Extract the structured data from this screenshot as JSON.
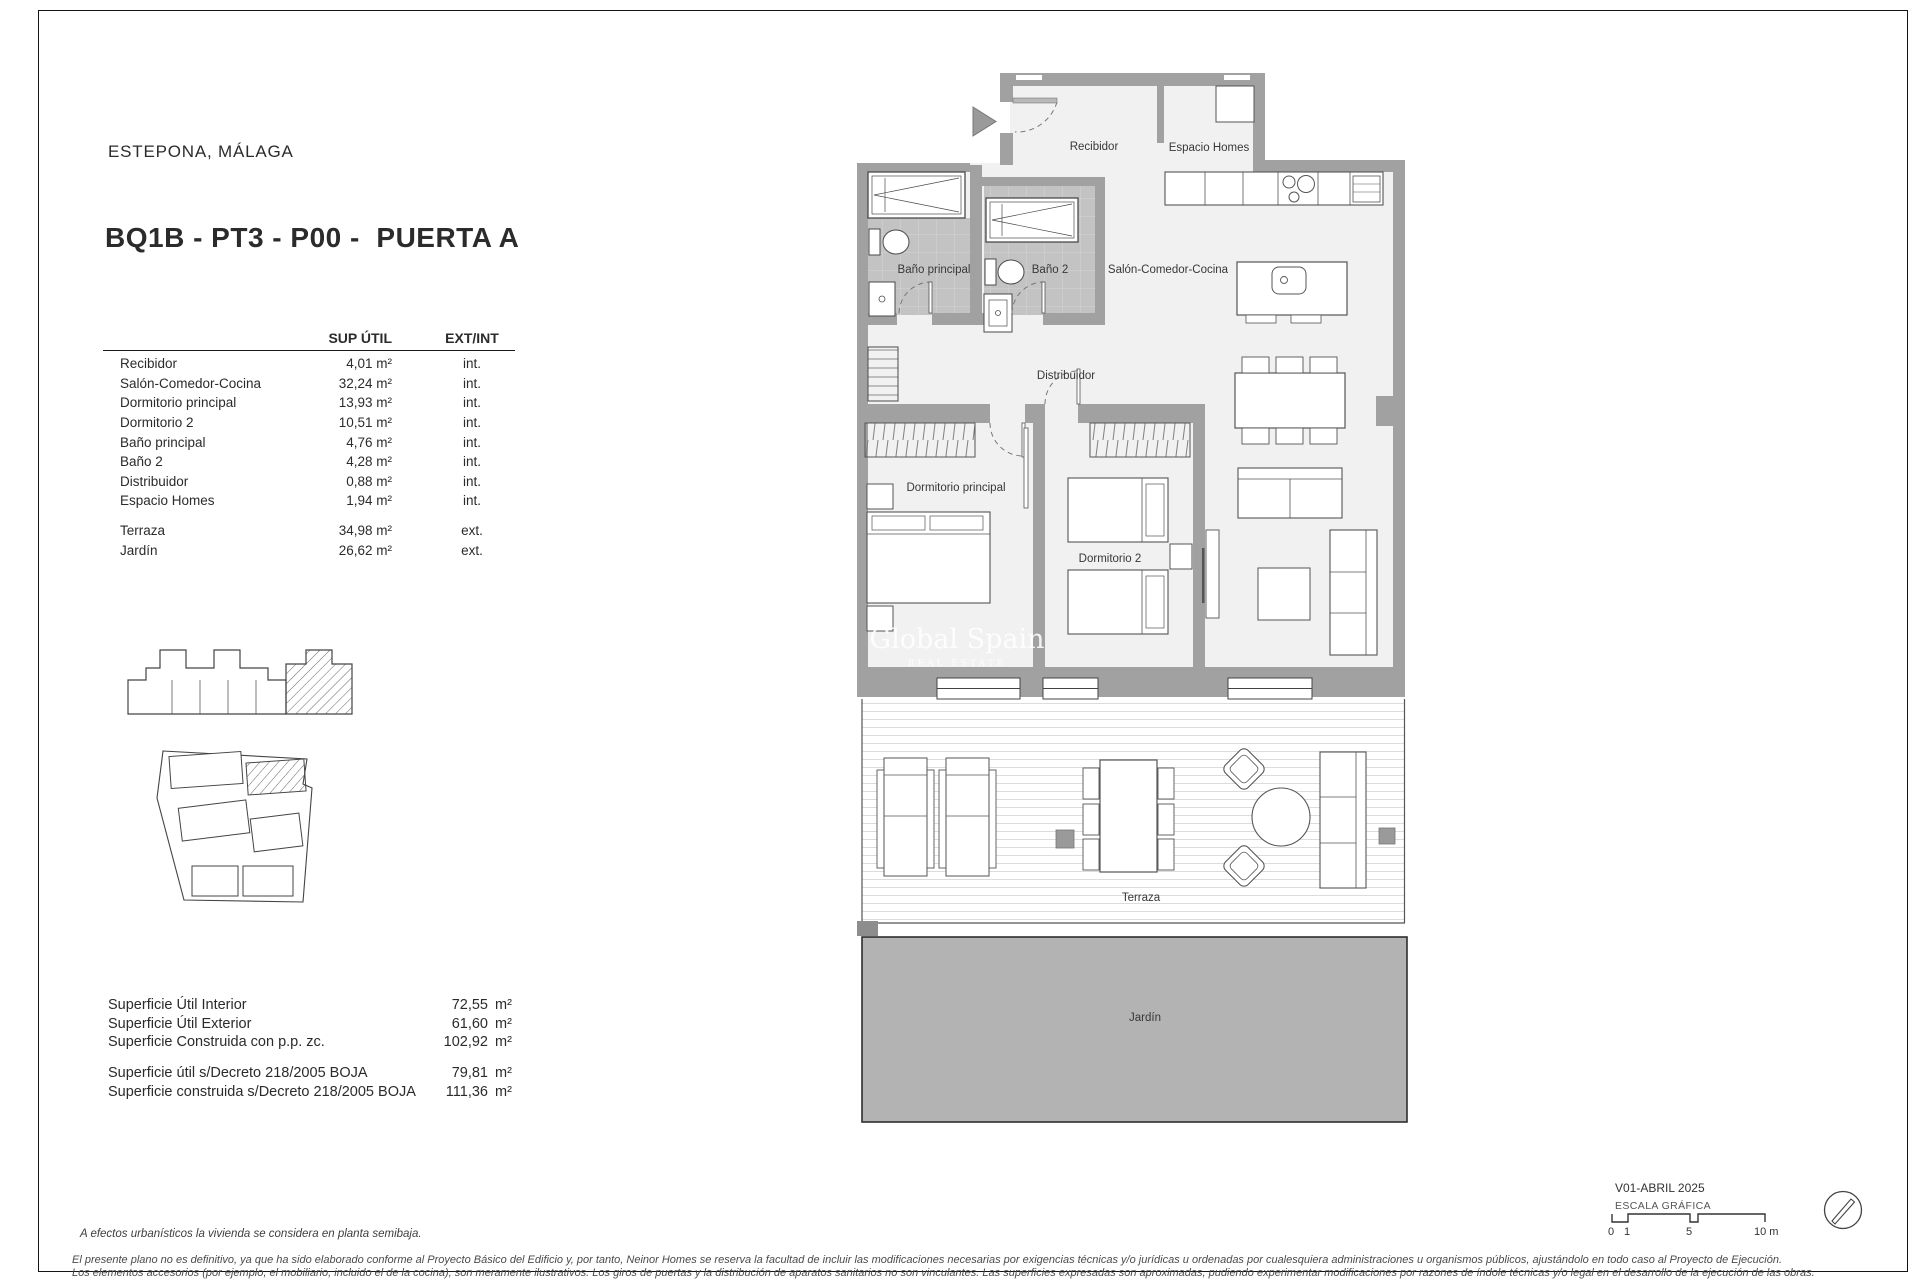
{
  "document": {
    "location": "ESTEPONA, MÁLAGA",
    "title": "BQ1B - PT3 - P00 -  PUERTA A"
  },
  "areas_table": {
    "col_area": "SUP ÚTIL",
    "col_type": "EXT/INT",
    "interior_rows": [
      {
        "room": "Recibidor",
        "area": "4,01 m²",
        "type": "int."
      },
      {
        "room": "Salón-Comedor-Cocina",
        "area": "32,24 m²",
        "type": "int."
      },
      {
        "room": "Dormitorio principal",
        "area": "13,93 m²",
        "type": "int."
      },
      {
        "room": "Dormitorio 2",
        "area": "10,51 m²",
        "type": "int."
      },
      {
        "room": "Baño principal",
        "area": "4,76 m²",
        "type": "int."
      },
      {
        "room": "Baño 2",
        "area": "4,28 m²",
        "type": "int."
      },
      {
        "room": "Distribuidor",
        "area": "0,88 m²",
        "type": "int."
      },
      {
        "room": "Espacio Homes",
        "area": "1,94 m²",
        "type": "int."
      }
    ],
    "exterior_rows": [
      {
        "room": "Terraza",
        "area": "34,98 m²",
        "type": "ext."
      },
      {
        "room": "Jardín",
        "area": "26,62 m²",
        "type": "ext."
      }
    ]
  },
  "summary": {
    "rows": [
      {
        "label": "Superficie Útil Interior",
        "value": "72,55",
        "unit": "m²"
      },
      {
        "label": "Superficie Útil Exterior",
        "value": "61,60",
        "unit": "m²"
      },
      {
        "label": "Superficie Construida con p.p. zc.",
        "value": "102,92",
        "unit": "m²"
      }
    ],
    "decree_rows": [
      {
        "label": "Superficie útil s/Decreto 218/2005 BOJA",
        "value": "79,81",
        "unit": "m²"
      },
      {
        "label": "Superficie construida s/Decreto 218/2005 BOJA",
        "value": "111,36",
        "unit": "m²"
      }
    ]
  },
  "notes": {
    "urbanistic": "A efectos urbanísticos la vivienda se considera en planta semibaja.",
    "disclaimer_line1": "El presente plano no es definitivo, ya que ha sido elaborado conforme al Proyecto Básico del Edificio y, por tanto, Neinor Homes se reserva la facultad de incluir las modificaciones necesarias por exigencias técnicas y/o jurídicas u ordenadas por cualesquiera administraciones u organismos públicos, ajustándolo en todo caso al Proyecto de Ejecución.",
    "disclaimer_line2": "Los elementos accesorios (por ejemplo, el mobiliario, incluido el de la cocina), son meramente ilustrativos. Los giros de puertas y la distribución de aparatos sanitarios no son vinculantes. Las superficies expresadas son aproximadas, pudiendo experimentar modificaciones por razones de índole técnicas y/o legal en el desarrollo de la ejecución de las obras."
  },
  "title_block": {
    "version": "V01-ABRIL 2025",
    "scale_label": "ESCALA GRÁFICA",
    "scale_ticks": [
      "0",
      "1",
      "5",
      "10 m"
    ]
  },
  "plan": {
    "rooms": {
      "recibidor": "Recibidor",
      "espacio_homes": "Espacio Homes",
      "salon": "Salón-Comedor-Cocina",
      "bano_principal": "Baño principal",
      "bano_2": "Baño 2",
      "distribuidor": "Distribuidor",
      "dormitorio_principal": "Dormitorio principal",
      "dormitorio_2": "Dormitorio 2",
      "terraza": "Terraza",
      "jardin": "Jardín"
    },
    "watermark_line1": "Global Spain",
    "watermark_line2": "REAL ESTATE"
  },
  "colors": {
    "wall": "#a1a1a1",
    "floor": "#f1f1f1",
    "tile": "#c3c3c3",
    "garden": "#b3b3b3",
    "line": "#4a4a4a"
  }
}
